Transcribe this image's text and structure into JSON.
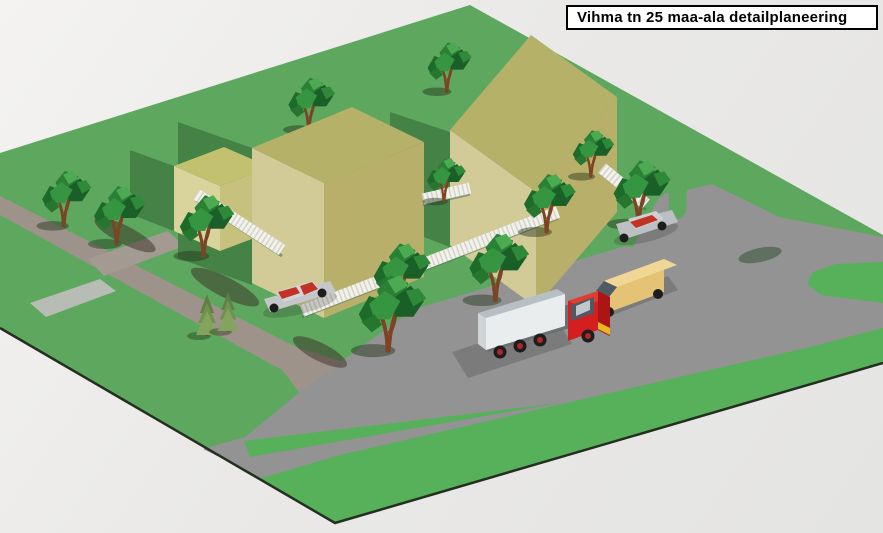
{
  "title": {
    "label": "Vihma tn 25 maa-ala detailplaneering"
  },
  "scene": {
    "type": "3d-isometric-site-plan-render",
    "palette": {
      "background": "#eae9e7",
      "grass": "#5ea75f",
      "grass_bright": "#57b05a",
      "grass_shadow": "#3f7b42",
      "road": "#939393",
      "street": "#9e938b",
      "walkway": "#9aa096",
      "terrace": "#b7bcb4",
      "fence": "#f2f1ea",
      "fence_shadow": "#46704a",
      "building_top": "#b5b169",
      "building_side_light": "#d2cb98",
      "building_side_dark": "#b8b06a",
      "annex_top": "#c2c170",
      "annex_side_light": "#d8d49c",
      "annex_side_dark": "#c6c27e",
      "tree_foliage": "#2a8136",
      "tree_trunk": "#7c4425",
      "truck_cab": "#d31f1f",
      "truck_bed": "#e9edee",
      "van_body": "#e4c276",
      "car_silver": "#c3c7ca",
      "glass_red": "#c23327",
      "terrain_edge": "#23301f",
      "title_bg": "#ffffff",
      "title_border": "#000000"
    },
    "terrain": {
      "name": "grass-site"
    },
    "roads": [
      {
        "name": "main-road"
      },
      {
        "name": "side-street"
      },
      {
        "name": "parking-area"
      },
      {
        "name": "plot-walkway"
      }
    ],
    "buildings": [
      {
        "name": "annex-small"
      },
      {
        "name": "building-left"
      },
      {
        "name": "building-right"
      }
    ],
    "fence": {
      "name": "white-picket-fence",
      "segments": 4
    },
    "vehicles": [
      {
        "name": "silver-car"
      },
      {
        "name": "parked-car-red-glass"
      },
      {
        "name": "delivery-van"
      },
      {
        "name": "dump-truck"
      }
    ],
    "vegetation": {
      "deciduous_trees": 12,
      "conifer_trees": 2
    }
  }
}
